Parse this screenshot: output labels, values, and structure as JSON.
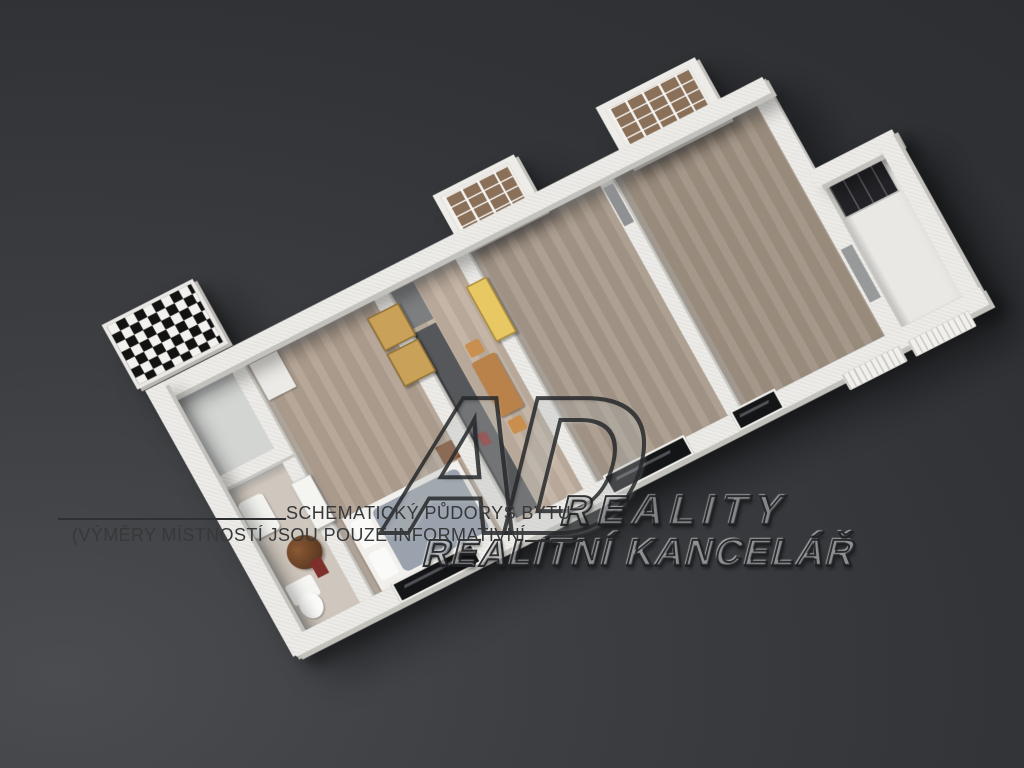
{
  "caption": {
    "line1": "SCHEMATICKÝ PŮDORYS BYTU",
    "line2": "(VÝMĚRY MÍSTNOSTÍ JSOU POUZE INFORMATIVNÍ"
  },
  "watermark": {
    "logo": "AD",
    "brand": "REALITY",
    "subtitle": "REALITNÍ KANCELÁŘ"
  },
  "colors": {
    "background_dark": "#2b2d31",
    "background_light": "#4a4c50",
    "wall_white": "#edece8",
    "floor_wood_bedroom": "#b2a292",
    "floor_wood_living": "#a09283",
    "floor_hall_light": "#eae8e4",
    "kitchen_counter_gray": "#55575a",
    "wardrobe_brown": "#8a7058",
    "door_tan": "#c9a159",
    "door_yellow": "#e7c863",
    "bed_duvet_gray": "#9aa3ad",
    "balcony_checker_dark": "#121212",
    "window_glass_dark": "#141517",
    "caption_text": "#37383a"
  }
}
